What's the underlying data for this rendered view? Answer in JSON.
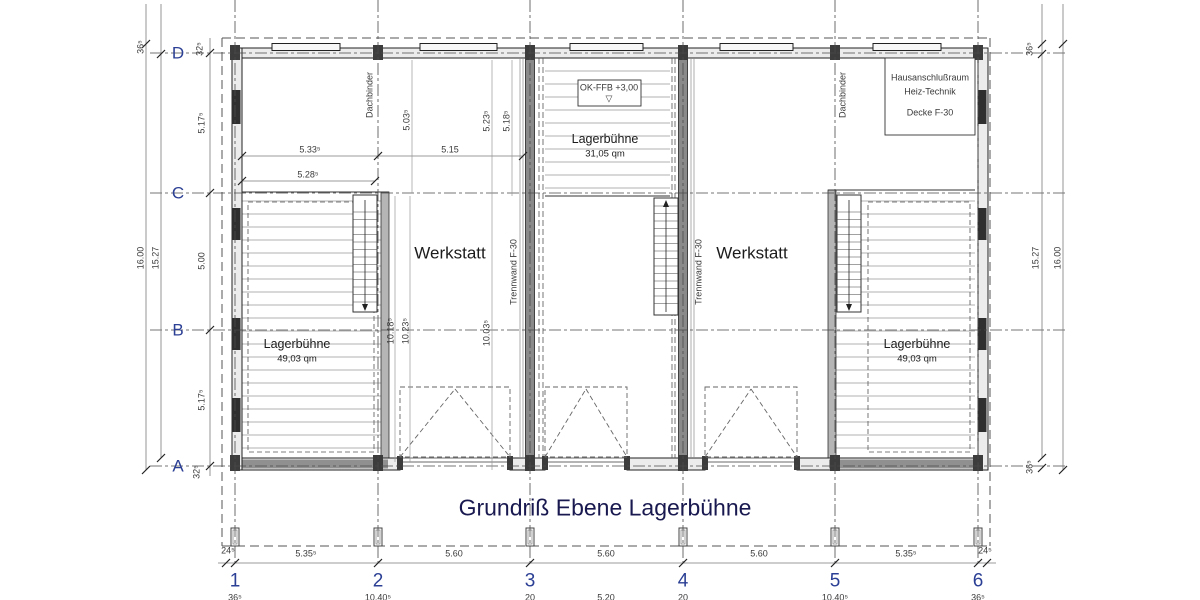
{
  "title": "Grundriß Ebene Lagerbühne",
  "grid": {
    "cols": [
      "1",
      "2",
      "3",
      "4",
      "5",
      "6"
    ],
    "rows": [
      "D",
      "C",
      "B",
      "A"
    ]
  },
  "rooms": {
    "werkstatt_left": "Werkstatt",
    "werkstatt_right": "Werkstatt",
    "lager_left": {
      "name": "Lagerbühne",
      "area": "49,03 qm"
    },
    "lager_center": {
      "name": "Lagerbühne",
      "area": "31,05 qm"
    },
    "lager_right": {
      "name": "Lagerbühne",
      "area": "49,03 qm"
    },
    "haus": {
      "line1": "Hausanschlußraum",
      "line2": "Heiz-Technik",
      "line3": "Decke F-30"
    }
  },
  "annotations": {
    "level": {
      "text": "OK-FFB +3,00",
      "icon": "▽"
    },
    "dachbinder": "Dachbinder",
    "trennwand": "Trennwand F-30"
  },
  "dims": {
    "b1": "24⁵",
    "b2": "5.35⁵",
    "b3": "5.60",
    "b4": "5.60",
    "b5": "5.60",
    "b6": "5.35⁵",
    "b7": "24⁵",
    "c1": "36⁵",
    "c2": "10,40⁵",
    "c3": "20",
    "c4": "5.20",
    "c5": "20",
    "c6": "10,40⁵",
    "c7": "36⁵",
    "l_outer": "16.00",
    "l_inner": "15.27",
    "l_36": "36⁵",
    "l_32t": "32⁵",
    "l_32b": "32⁵",
    "l_dc": "5.17⁵",
    "l_cb": "5.00",
    "l_ba": "5.17⁵",
    "r_inner": "15.27",
    "r_outer": "16.00",
    "r_36t": "36⁵",
    "r_36b": "36⁵",
    "h1": "5.33⁵",
    "h2": "5.15",
    "h3": "5.28⁵",
    "v1": "5.03⁵",
    "v2": "5.23⁵",
    "v3": "5.18⁵",
    "v4": "10.18⁵",
    "v5": "10.23⁵",
    "v6": "10.03⁵"
  }
}
